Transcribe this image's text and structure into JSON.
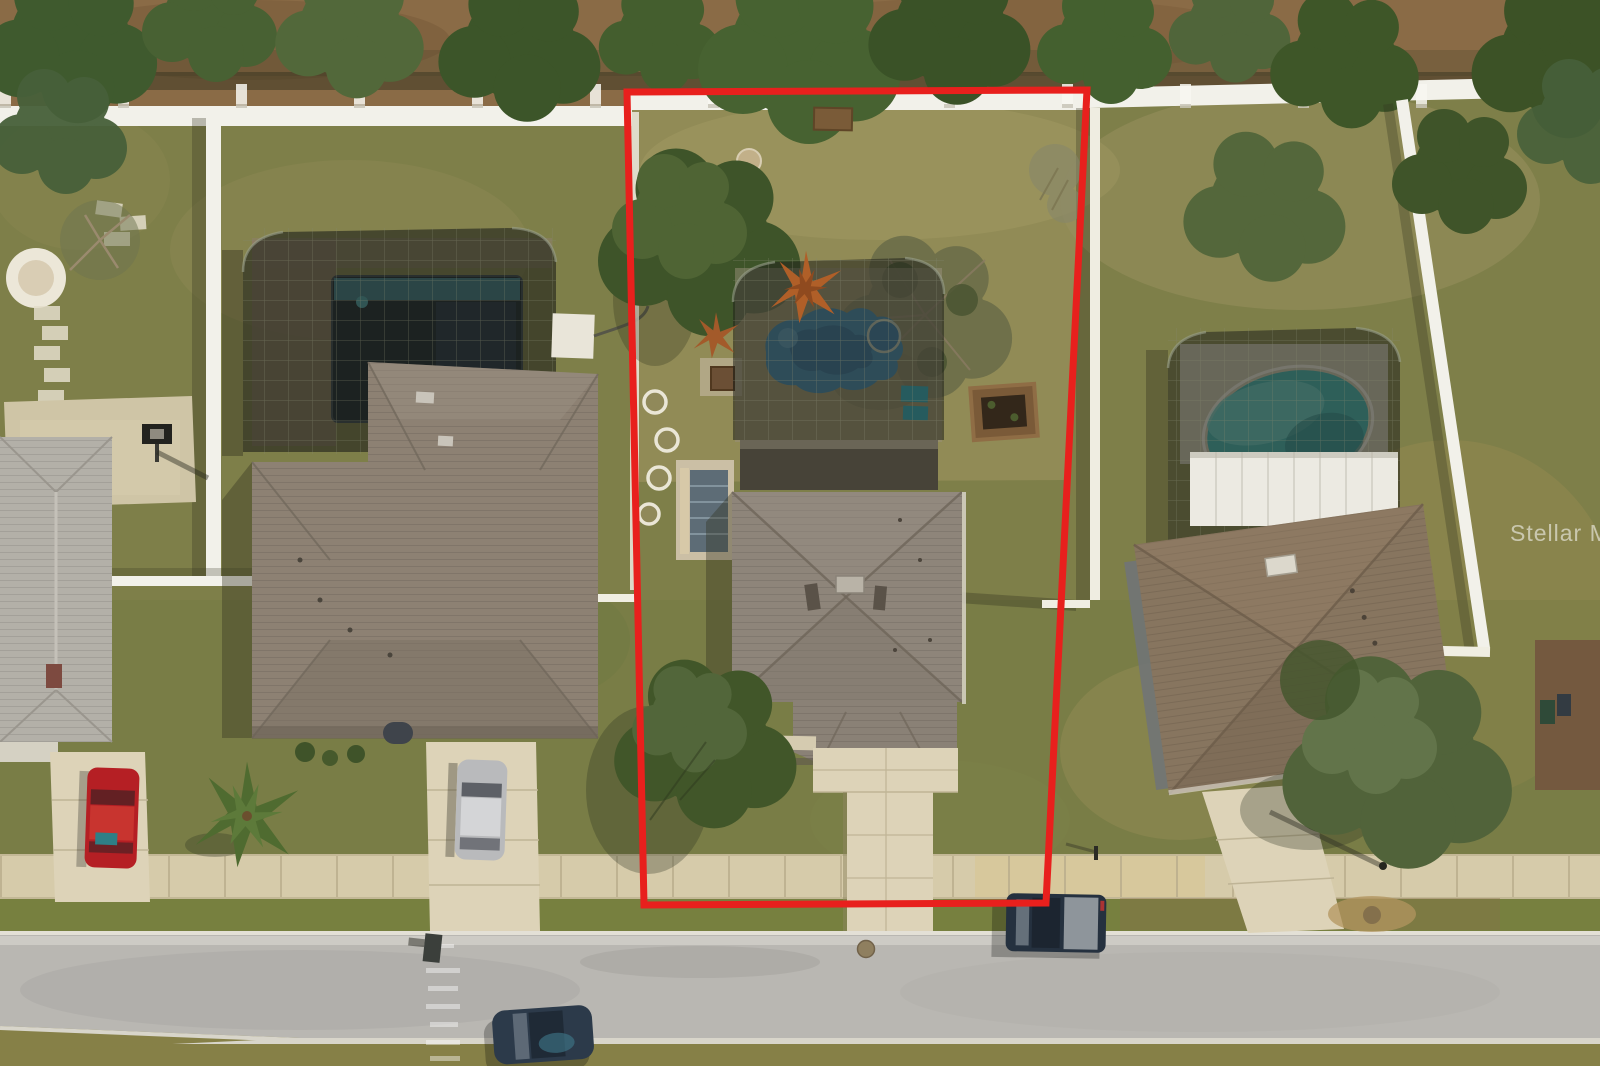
{
  "meta": {
    "type": "aerial-drone-photo",
    "description": "Overhead aerial view of a suburban Florida lot outlined in red, showing the subject home with screened pool, two neighboring homes with pools, driveways with parked cars, white vinyl fencing, sidewalk and street"
  },
  "watermark": {
    "text": "Stellar MLS",
    "color": "#ffffff",
    "opacity": "0.55"
  },
  "property_boundary": {
    "color": "#e8201d",
    "stroke_width": "7",
    "points": "627,92 1087,90 1046,903 644,905"
  },
  "palette": {
    "grass_base": "#7e7f49",
    "grass_dry": "#99905c",
    "dirt": "#8a6b46",
    "street": "#b9b7b2",
    "sidewalk": "#d6cbaa",
    "concrete": "#ddd3b8",
    "fence_white": "#f2f1ea",
    "roof_subject": "#8e857a",
    "roof_left": "#8d8173",
    "roof_right": "#87755f",
    "roof_far_left": "#b3b0a8",
    "screen_enclosure": "#20221b",
    "pool_subject": "#3f7ea3",
    "pool_left_deep": "#17222b",
    "pool_left_shallow": "#3d7e8c",
    "pool_right": "#3fa8a5",
    "car_red": "#b51f24",
    "car_silver": "#b9babc",
    "truck_dark": "#25313f",
    "car_blue": "#2c3a4a"
  },
  "scene_objects": [
    "subject-lot-outlined-in-red",
    "subject-house-hip-roof",
    "subject-screened-pool-enclosure",
    "freeform-blue-pool",
    "raised-garden-bed",
    "backyard-trees",
    "front-yard-tree",
    "left-neighbor-house",
    "left-neighbor-pool-enclosure",
    "basketball-pad",
    "far-left-gray-roof-house",
    "red-car",
    "silver-car",
    "palm-tree",
    "right-neighbor-house",
    "right-neighbor-teal-pool",
    "white-vinyl-fences",
    "sidewalk",
    "street",
    "dark-pickup-truck",
    "dark-blue-car",
    "manhole-cover"
  ]
}
